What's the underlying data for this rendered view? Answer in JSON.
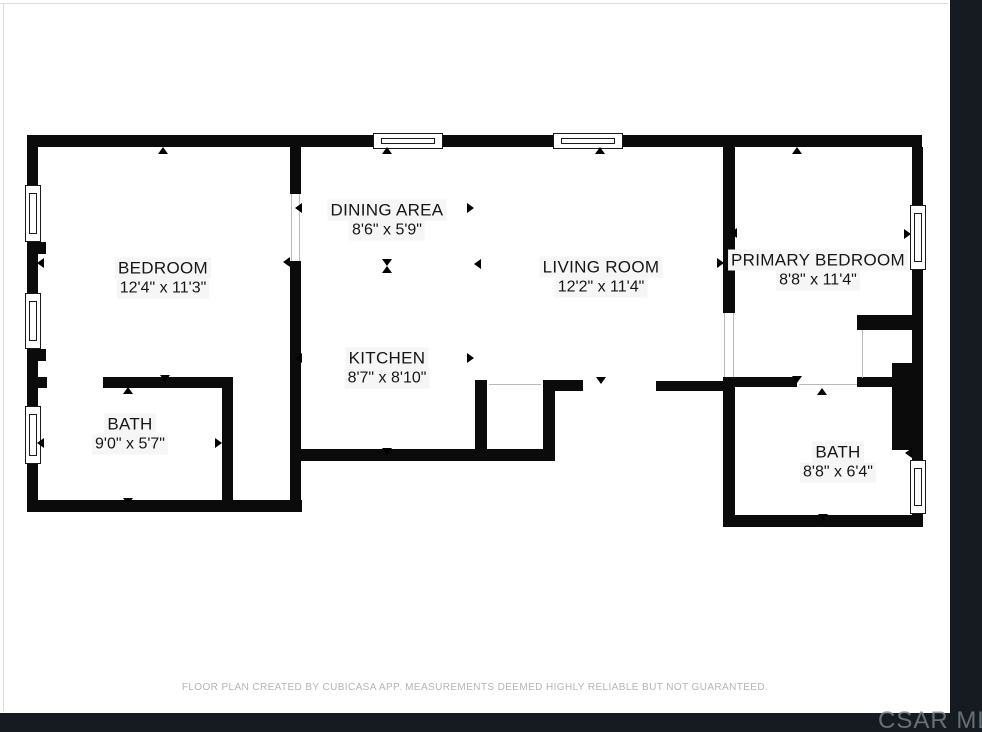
{
  "viewer": {
    "watermark": "CSAR MLS",
    "background_color": "#161b21"
  },
  "floorplan": {
    "disclaimer": "FLOOR PLAN CREATED BY CUBICASA APP. MEASUREMENTS DEEMED HIGHLY RELIABLE BUT NOT GUARANTEED.",
    "wall_color": "#0b0b0b",
    "rooms": [
      {
        "id": "bedroom",
        "name": "BEDROOM",
        "dims": "12'4\" x 11'3\"",
        "cx": 163,
        "cy": 278
      },
      {
        "id": "dining-area",
        "name": "DINING AREA",
        "dims": "8'6\" x 5'9\"",
        "cx": 387,
        "cy": 220
      },
      {
        "id": "kitchen",
        "name": "KITCHEN",
        "dims": "8'7\" x 8'10\"",
        "cx": 387,
        "cy": 368
      },
      {
        "id": "living-room",
        "name": "LIVING ROOM",
        "dims": "12'2\" x 11'4\"",
        "cx": 601,
        "cy": 277
      },
      {
        "id": "primary-bedroom",
        "name": "PRIMARY BEDROOM",
        "dims": "8'8\" x 11'4\"",
        "cx": 818,
        "cy": 270
      },
      {
        "id": "bath",
        "name": "BATH",
        "dims": "9'0\" x 5'7\"",
        "cx": 130,
        "cy": 434
      },
      {
        "id": "bath-2",
        "name": "BATH",
        "dims": "8'8\" x 6'4\"",
        "cx": 838,
        "cy": 462
      }
    ],
    "walls": [
      [
        27,
        135,
        346,
        12
      ],
      [
        443,
        135,
        110,
        12
      ],
      [
        623,
        135,
        299,
        12
      ],
      [
        27,
        147,
        11,
        38
      ],
      [
        27,
        242,
        11,
        51
      ],
      [
        27,
        349,
        11,
        57
      ],
      [
        27,
        464,
        11,
        48
      ],
      [
        912,
        147,
        11,
        58
      ],
      [
        912,
        270,
        11,
        93
      ],
      [
        912,
        450,
        11,
        10
      ],
      [
        912,
        514,
        11,
        13
      ],
      [
        27,
        500,
        275,
        12
      ],
      [
        290,
        449,
        265,
        12
      ],
      [
        723,
        515,
        200,
        12
      ],
      [
        290,
        147,
        11,
        47
      ],
      [
        290,
        261,
        11,
        251
      ],
      [
        38,
        377,
        9,
        11
      ],
      [
        103,
        377,
        130,
        11
      ],
      [
        222,
        388,
        11,
        124
      ],
      [
        38,
        242,
        8,
        12
      ],
      [
        38,
        349,
        8,
        12
      ],
      [
        475,
        380,
        12,
        81
      ],
      [
        543,
        380,
        40,
        11
      ],
      [
        543,
        391,
        12,
        70
      ],
      [
        656,
        381,
        79,
        10
      ],
      [
        723,
        147,
        12,
        166
      ],
      [
        723,
        377,
        12,
        150
      ],
      [
        735,
        377,
        62,
        10
      ],
      [
        857,
        377,
        35,
        10
      ],
      [
        857,
        315,
        56,
        15
      ],
      [
        892,
        363,
        31,
        87
      ]
    ],
    "windows": [
      [
        373,
        133,
        70,
        16,
        "h"
      ],
      [
        553,
        133,
        70,
        16,
        "h"
      ],
      [
        25,
        185,
        16,
        57,
        "v"
      ],
      [
        25,
        293,
        16,
        56,
        "v"
      ],
      [
        25,
        406,
        16,
        58,
        "v"
      ],
      [
        910,
        205,
        16,
        65,
        "v"
      ],
      [
        910,
        460,
        16,
        54,
        "v"
      ]
    ],
    "door_openings": [
      [
        291,
        194,
        1,
        67
      ],
      [
        299,
        194,
        1,
        67
      ],
      [
        724,
        313,
        1,
        64
      ],
      [
        733,
        313,
        1,
        64
      ],
      [
        489,
        384,
        52,
        1
      ],
      [
        799,
        384,
        58,
        1
      ],
      [
        862,
        330,
        1,
        48
      ]
    ],
    "arrows": [
      [
        163,
        151,
        "up"
      ],
      [
        387,
        151,
        "up"
      ],
      [
        600,
        151,
        "up"
      ],
      [
        797,
        151,
        "up"
      ],
      [
        41,
        263,
        "left"
      ],
      [
        299,
        208,
        "left"
      ],
      [
        287,
        262,
        "left"
      ],
      [
        471,
        208,
        "right"
      ],
      [
        478,
        264,
        "left"
      ],
      [
        387,
        263,
        "down"
      ],
      [
        387,
        270,
        "up"
      ],
      [
        299,
        358,
        "left"
      ],
      [
        471,
        358,
        "right"
      ],
      [
        387,
        452,
        "down"
      ],
      [
        601,
        381,
        "down"
      ],
      [
        734,
        233,
        "left"
      ],
      [
        721,
        263,
        "right"
      ],
      [
        908,
        234,
        "right"
      ],
      [
        797,
        380,
        "down"
      ],
      [
        822,
        392,
        "up"
      ],
      [
        41,
        443,
        "left"
      ],
      [
        219,
        443,
        "right"
      ],
      [
        165,
        379,
        "down"
      ],
      [
        128,
        391,
        "up"
      ],
      [
        128,
        502,
        "down"
      ],
      [
        823,
        518,
        "down"
      ],
      [
        909,
        453,
        "left"
      ]
    ]
  }
}
